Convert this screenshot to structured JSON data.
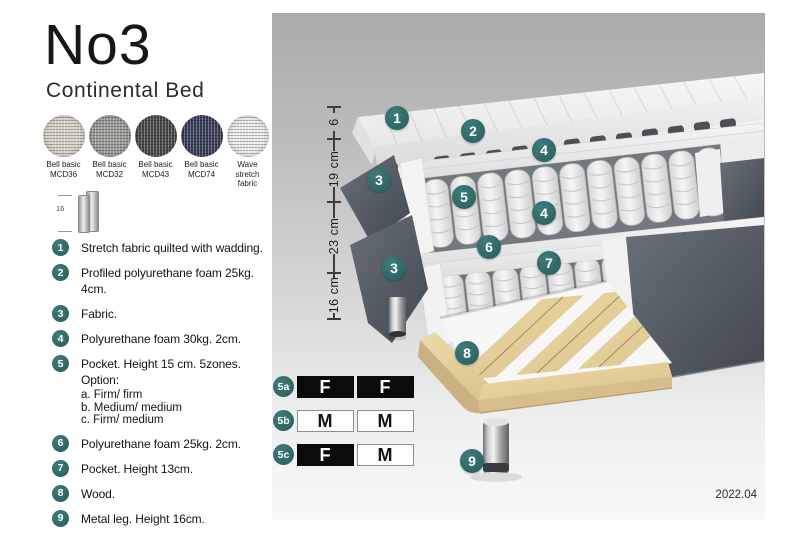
{
  "title": "No3",
  "subtitle": "Continental Bed",
  "swatches": [
    {
      "line1": "Bell basic",
      "line2": "MCD36",
      "color": "#d9d4c9"
    },
    {
      "line1": "Bell basic",
      "line2": "MCD32",
      "color": "#9c9c99"
    },
    {
      "line1": "Bell basic",
      "line2": "MCD43",
      "color": "#4b4b49"
    },
    {
      "line1": "Bell basic",
      "line2": "MCD74",
      "color": "#3c415c"
    },
    {
      "line1": "Wave",
      "line2": "stretch fabric",
      "color": "#e9ebec"
    }
  ],
  "leg_icon": {
    "label": "16"
  },
  "legend": [
    {
      "num": "1",
      "text": "Stretch fabric quilted with wadding."
    },
    {
      "num": "2",
      "text": "Profiled polyurethane foam 25kg. 4cm."
    },
    {
      "num": "3",
      "text": "Fabric."
    },
    {
      "num": "4",
      "text": "Polyurethane foam 30kg. 2cm."
    },
    {
      "num": "5",
      "text": "Pocket. Height 15 cm. 5zones. Option:",
      "options": [
        "a. Firm/ firm",
        "b. Medium/ medium",
        "c. Firm/ medium"
      ]
    },
    {
      "num": "6",
      "text": "Polyurethane foam 25kg. 2cm."
    },
    {
      "num": "7",
      "text": "Pocket. Height 13cm."
    },
    {
      "num": "8",
      "text": "Wood."
    },
    {
      "num": "9",
      "text": "Metal leg. Height 16cm."
    }
  ],
  "diagram": {
    "dimensions": [
      "6",
      "19 cm",
      "23 cm",
      "16 cm"
    ],
    "callouts": [
      "1",
      "2",
      "4",
      "3",
      "5",
      "4",
      "6",
      "7",
      "3",
      "8",
      "9"
    ],
    "firmness": [
      {
        "label": "5a",
        "left": "F",
        "right": "F"
      },
      {
        "label": "5b",
        "left": "M",
        "right": "M"
      },
      {
        "label": "5c",
        "left": "F",
        "right": "M"
      }
    ],
    "version": "2022.04"
  },
  "colors": {
    "accent_teal": "#2f6a6a",
    "panel_gray_top": "#ababab",
    "panel_gray_bottom": "#f8f8f8",
    "fabric_slate": "#565c66",
    "wood": "#e2cfa0",
    "firmness_dark_cell": "#0b0b0b"
  }
}
